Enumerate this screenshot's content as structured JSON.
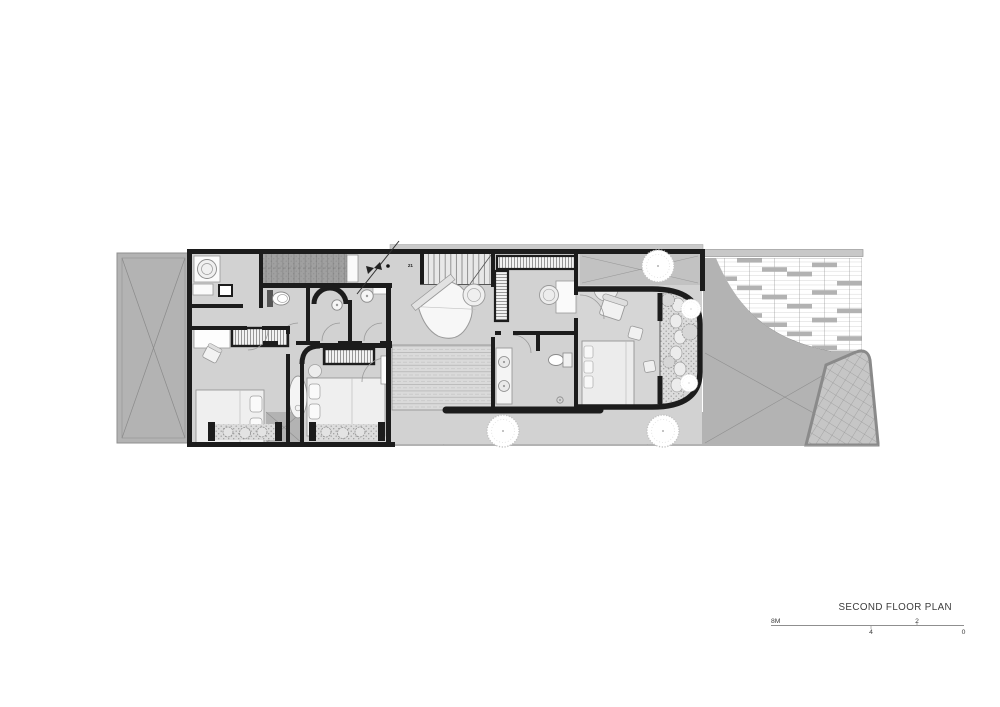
{
  "title_block": {
    "title": "SECOND FLOOR PLAN"
  },
  "scale_bar": {
    "labels": [
      "8M",
      "4",
      "2",
      "0"
    ]
  },
  "plan": {
    "stair_label": "21"
  },
  "colors": {
    "background": "#ffffff",
    "site_gray": "#b3b3b3",
    "floor_gray": "#d2d2d2",
    "wall_dark": "#1c1c1c",
    "furniture_light": "#f2f2f2",
    "text": "#3c3c3c"
  }
}
